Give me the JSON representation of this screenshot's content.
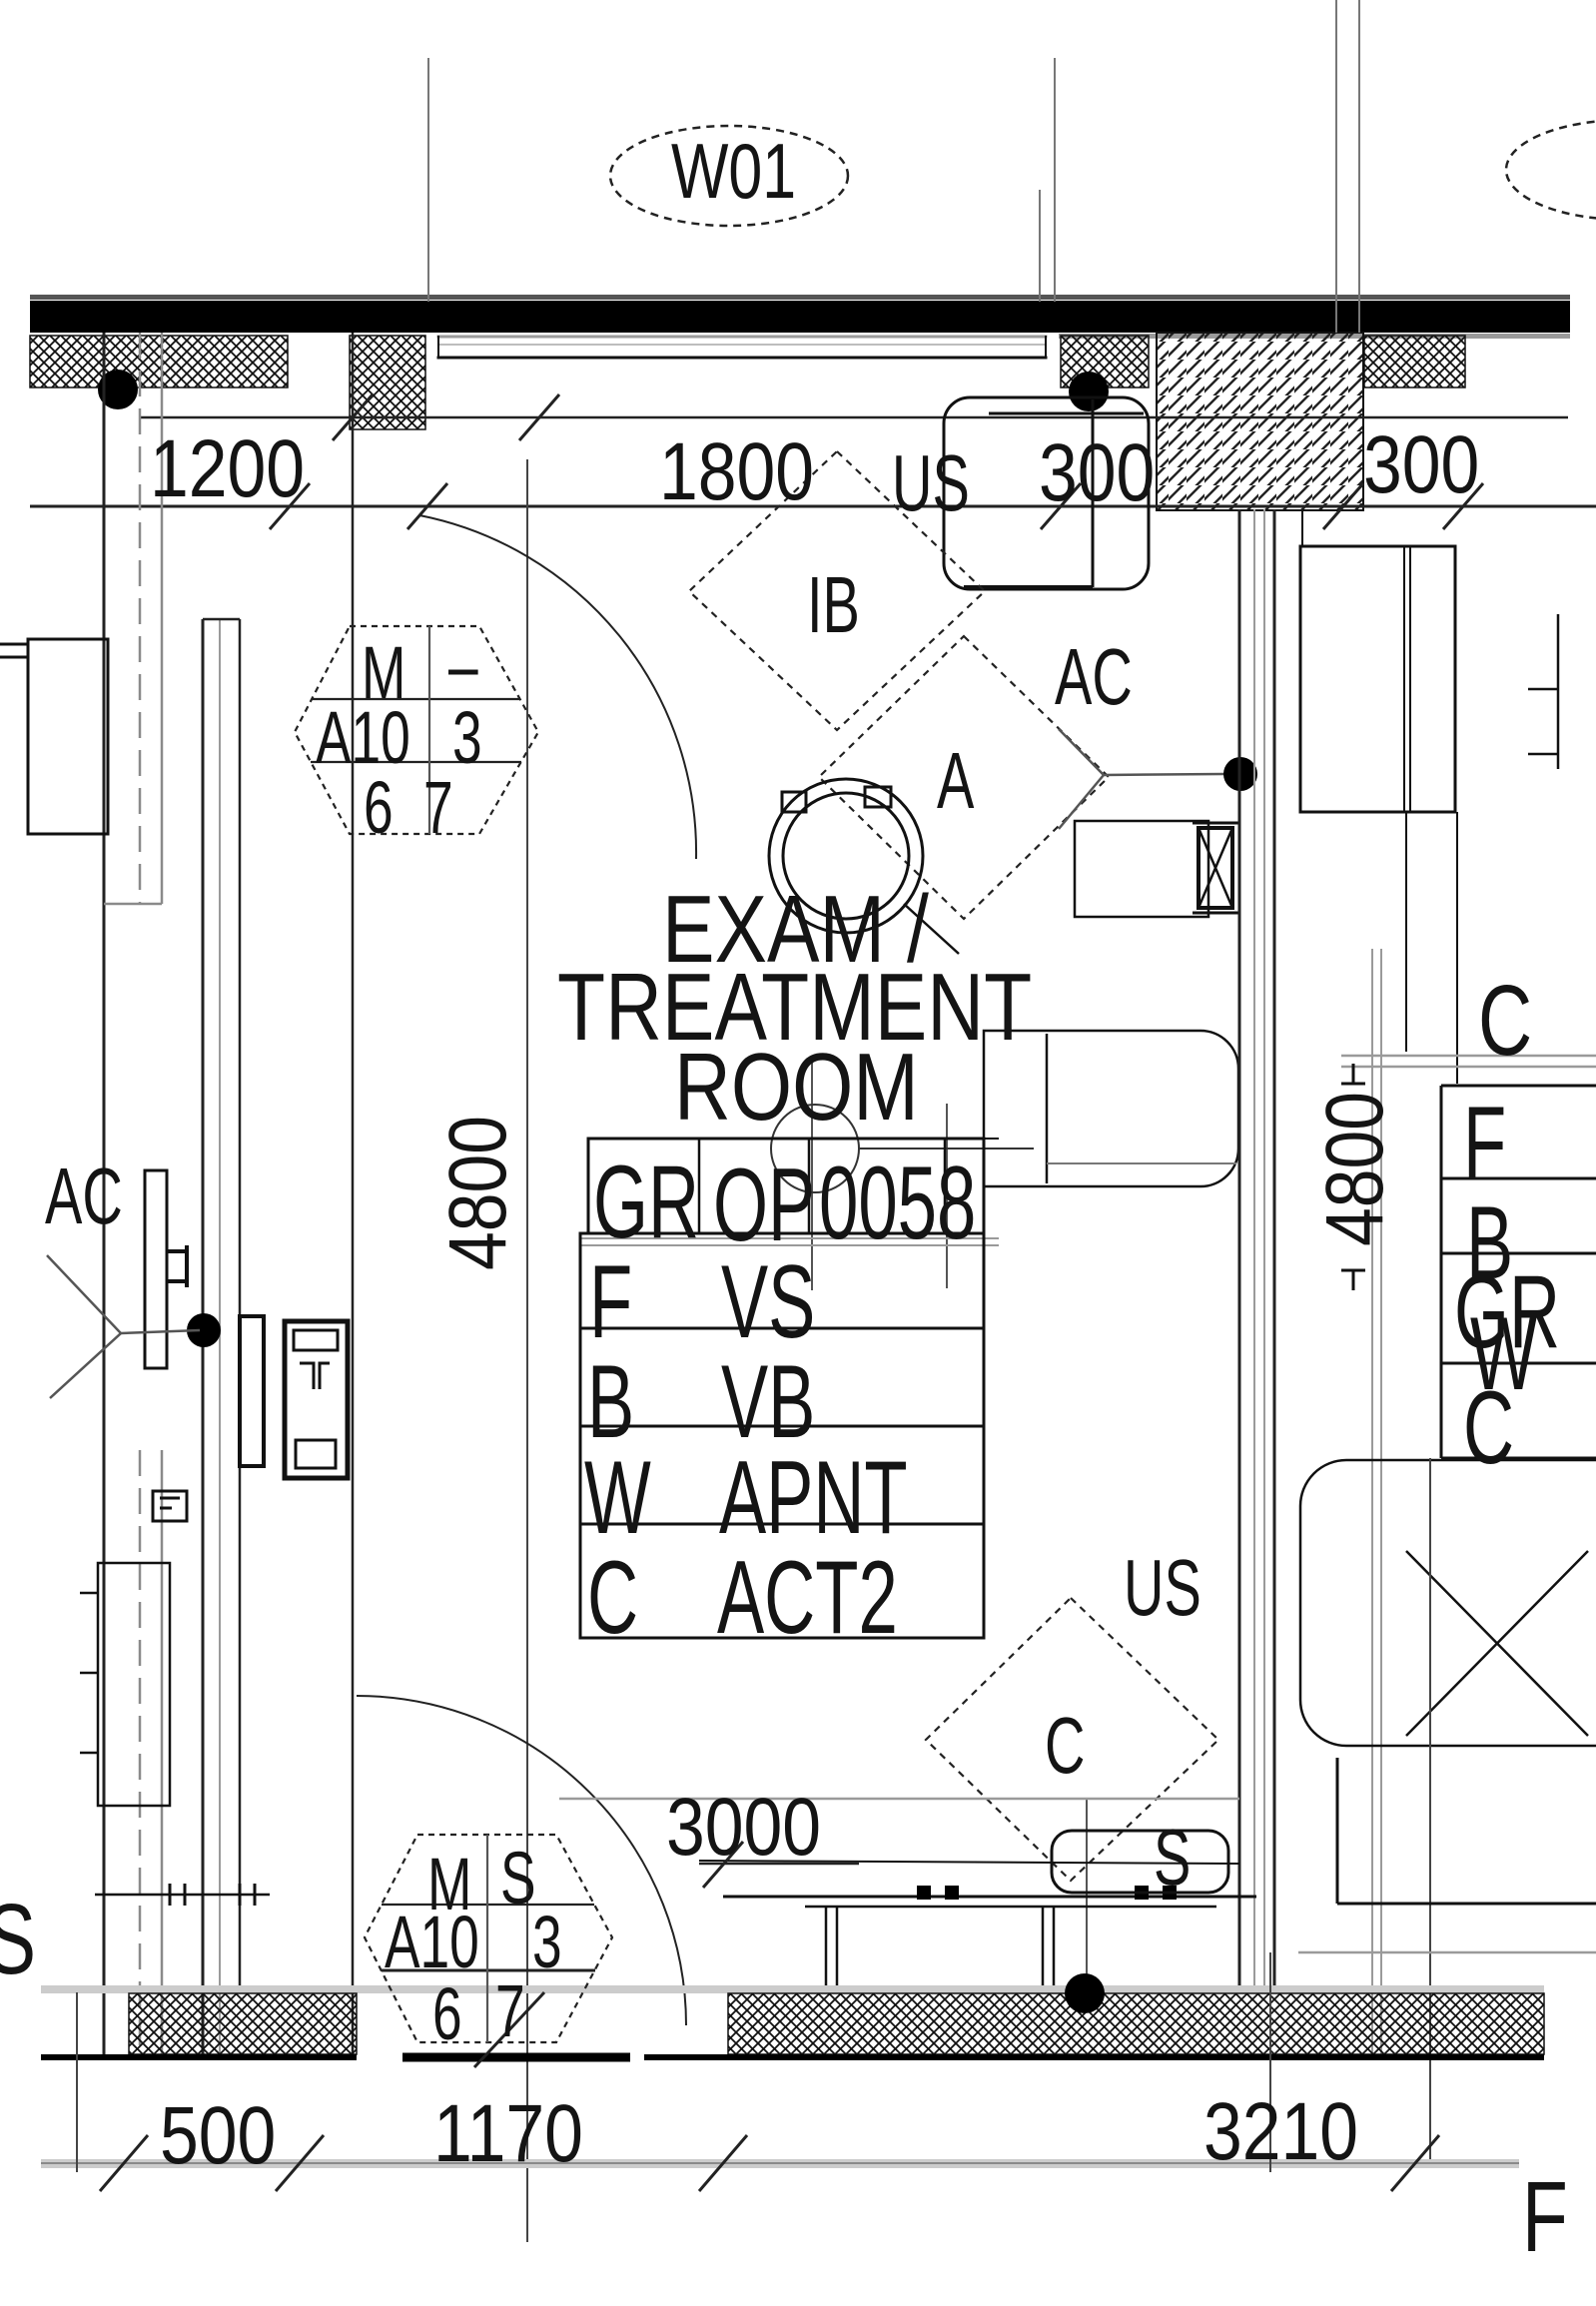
{
  "meta": {
    "type": "architectural-floor-plan",
    "ink": "#141414",
    "wall_color": "#000000",
    "gray_line": "#9a9a9a",
    "light_band": "#cccccc"
  },
  "window_tag": {
    "label": "W01"
  },
  "room": {
    "name_line1": "EXAM /",
    "name_line2": "TREATMENT",
    "name_line3": "ROOM"
  },
  "dims": {
    "top": [
      "1200",
      "1800",
      "300",
      "300"
    ],
    "bottom": [
      "500",
      "1170",
      "3210"
    ],
    "width": "3000",
    "height_left": "4800",
    "height_right": "4800"
  },
  "labels": {
    "us_top": "US",
    "us_mid": "US",
    "ac_left": "AC",
    "ac_right": "AC",
    "ib": "IB",
    "a": "A",
    "c": "C",
    "sink": "S"
  },
  "hex_top": {
    "c1": "M",
    "c2": "–",
    "c3": "A10",
    "c4": "3",
    "c5": "6",
    "c6": "7"
  },
  "hex_bottom": {
    "c1": "M",
    "c2": "S",
    "c3": "A10",
    "c4": "3",
    "c5": "6",
    "c6": "7"
  },
  "schedule": {
    "header": [
      "GR",
      "OP",
      "0058"
    ],
    "rows": [
      [
        "F",
        "VS"
      ],
      [
        "B",
        "VB"
      ],
      [
        "W",
        "APNT"
      ],
      [
        "C",
        "ACT2"
      ]
    ]
  },
  "adjacent_room": {
    "big_label": "C",
    "rows": [
      "F",
      "B",
      "GR",
      "W",
      "C"
    ],
    "partial_top": "t",
    "partial_bottom_right": "F",
    "partial_bottom_left": "S"
  }
}
